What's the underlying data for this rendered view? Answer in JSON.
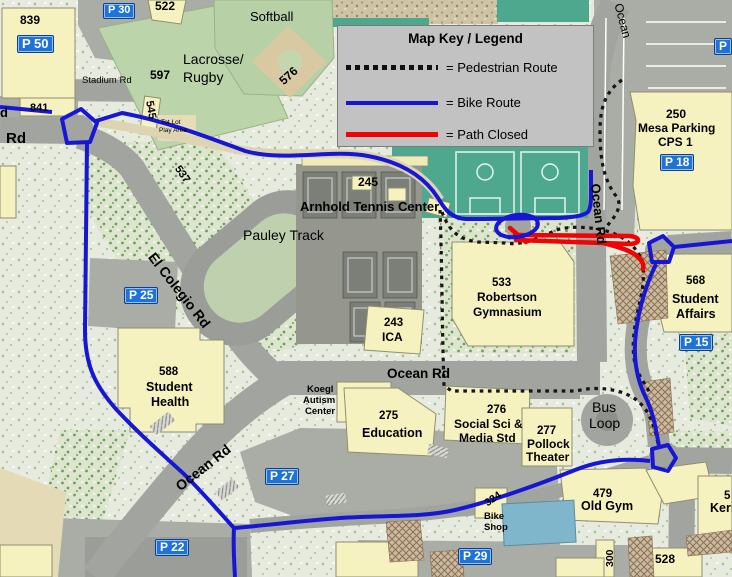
{
  "legend": {
    "title": "Map Key / Legend",
    "items": [
      {
        "label": "= Pedestrian Route",
        "style": "pedestrian",
        "color": "#111111"
      },
      {
        "label": "= Bike Route",
        "style": "bike",
        "color": "#1717d3"
      },
      {
        "label": "= Path Closed",
        "style": "closed",
        "color": "#ee0404"
      }
    ]
  },
  "colors": {
    "bike_route": "#1717d3",
    "path_closed": "#ee0404",
    "pedestrian_route": "#151515",
    "parking_badge": "#1e73d8",
    "building": "#f6f2bf",
    "road": "#a2a49f",
    "soccer_field": "#4ea88d",
    "pool": "#80b6cc"
  },
  "badges": {
    "p50": "P 50",
    "p30": "P 30",
    "p18": "P 18",
    "p25": "P 25",
    "p27": "P 27",
    "p22": "P 22",
    "p29": "P 29",
    "p15": "P 15",
    "p_top_right": "P"
  },
  "labels": {
    "n839": "839",
    "n522": "522",
    "softball": "Softball",
    "lacrosse1": "Lacrosse/",
    "lacrosse2": "Rugby",
    "n597": "597",
    "stadium_rd": "Stadium Rd",
    "n841": "841",
    "n545": "545",
    "tot_lot1": "Tot Lot",
    "tot_lot2": "Play Area",
    "edge_d": "d",
    "edge_rd": "Rd",
    "n576": "576",
    "n537": "537",
    "ocean_top": "Ocean",
    "mesa_num": "250",
    "mesa_name": "Mesa Parking",
    "mesa_cps": "CPS 1",
    "n245": "245",
    "arnhold": "Arnhold Tennis Center",
    "pauley": "Pauley Track",
    "el_colegio": "El Colegio Rd",
    "sh_num": "588",
    "sh_l1": "Student",
    "sh_l2": "Health",
    "ica_num": "243",
    "ica": "ICA",
    "gym_num": "533",
    "gym_l1": "Robertson",
    "gym_l2": "Gymnasium",
    "ocean_vert": "Ocean Rd",
    "ocean_horiz": "Ocean Rd",
    "ocean_sw": "Ocean Rd",
    "sa_num": "568",
    "sa_l1": "Student",
    "sa_l2": "Affairs",
    "koegl1": "Koegl",
    "koegl2": "Autism",
    "koegl3": "Center",
    "ed_num": "275",
    "ed_name": "Education",
    "ss_num": "276",
    "ss_l1": "Social Sci &",
    "ss_l2": "Media Std",
    "pt_num": "277",
    "pt_l1": "Pollock",
    "pt_l2": "Theater",
    "bus1": "Bus",
    "bus2": "Loop",
    "og_num": "479",
    "og_name": "Old Gym",
    "bs_num": "324",
    "bs_l1": "Bike",
    "bs_l2": "Shop",
    "n300": "300",
    "n528": "528",
    "kerr_num": "5",
    "kerr_name": "Kerr"
  }
}
